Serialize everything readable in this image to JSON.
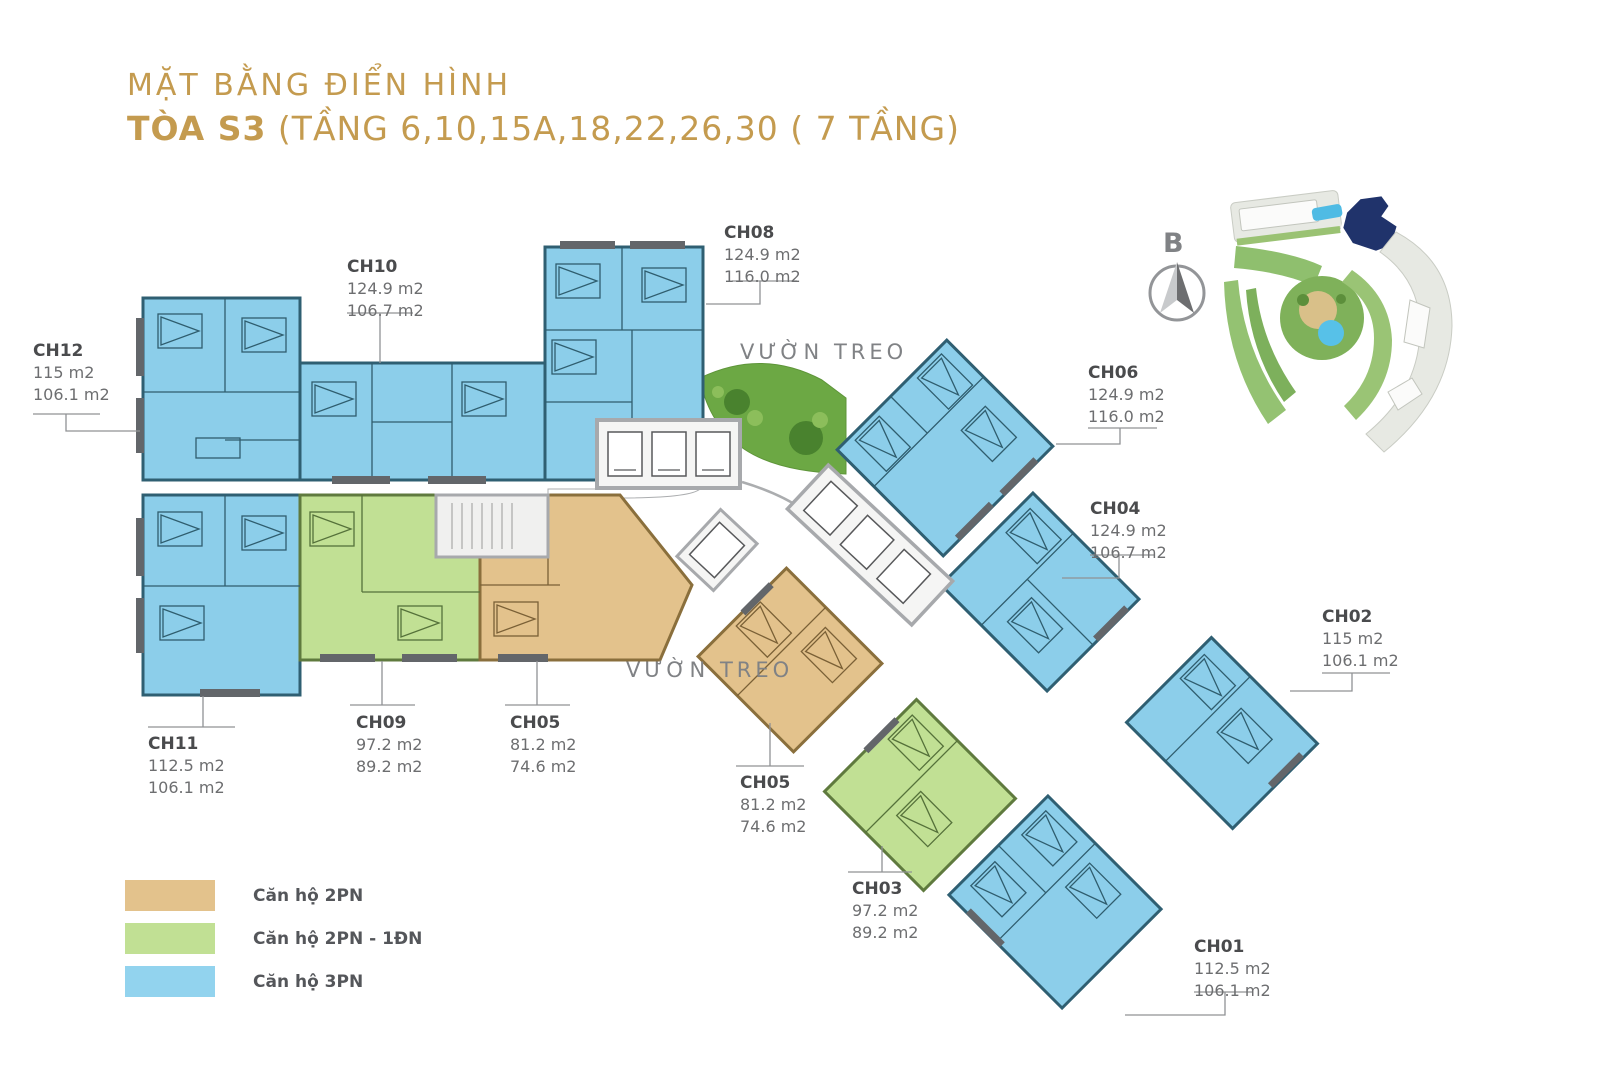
{
  "title": {
    "line1": "MẶT BẰNG ĐIỂN HÌNH",
    "line2_bold": "TÒA S3",
    "line2_rest": " (TẦNG 6,10,15A,18,22,26,30 ( 7 TẦNG)"
  },
  "compass": {
    "label": "B"
  },
  "garden": {
    "top_label": "VƯỜN TREO",
    "bottom_label": "VƯỜN TREO"
  },
  "legend": {
    "items": [
      {
        "label": "Căn hộ 2PN",
        "color": "#E3C28C"
      },
      {
        "label": "Căn hộ 2PN - 1ĐN",
        "color": "#C1E094"
      },
      {
        "label": "Căn hộ 3PN",
        "color": "#92D3EE"
      }
    ]
  },
  "colors": {
    "title_gold": "#C49B4F",
    "unit_3pn_fill": "#8CCEEA",
    "unit_2pn_fill": "#E3C28C",
    "unit_2pn1dn_fill": "#C1E094",
    "garden_green": "#6CA844",
    "label_text": "#6D6E70"
  },
  "units": [
    {
      "id": "CH12",
      "area1": "115 m2",
      "area2": "106.1 m2",
      "type": "3PN"
    },
    {
      "id": "CH10",
      "area1": "124.9 m2",
      "area2": "106.7 m2",
      "type": "3PN"
    },
    {
      "id": "CH08",
      "area1": "124.9 m2",
      "area2": "116.0 m2",
      "type": "3PN"
    },
    {
      "id": "CH06",
      "area1": "124.9 m2",
      "area2": "116.0 m2",
      "type": "3PN"
    },
    {
      "id": "CH04",
      "area1": "124.9 m2",
      "area2": "106.7 m2",
      "type": "3PN"
    },
    {
      "id": "CH02",
      "area1": "115 m2",
      "area2": "106.1 m2",
      "type": "3PN"
    },
    {
      "id": "CH11",
      "area1": "112.5 m2",
      "area2": "106.1 m2",
      "type": "3PN"
    },
    {
      "id": "CH09",
      "area1": "97.2 m2",
      "area2": "89.2 m2",
      "type": "2PN-1DN"
    },
    {
      "id": "CH05",
      "area1": "81.2 m2",
      "area2": "74.6 m2",
      "type": "2PN"
    },
    {
      "id": "CH05",
      "area1": "81.2 m2",
      "area2": "74.6 m2",
      "type": "2PN"
    },
    {
      "id": "CH03",
      "area1": "97.2 m2",
      "area2": "89.2 m2",
      "type": "2PN-1DN"
    },
    {
      "id": "CH01",
      "area1": "112.5 m2",
      "area2": "106.1 m2",
      "type": "3PN"
    }
  ]
}
